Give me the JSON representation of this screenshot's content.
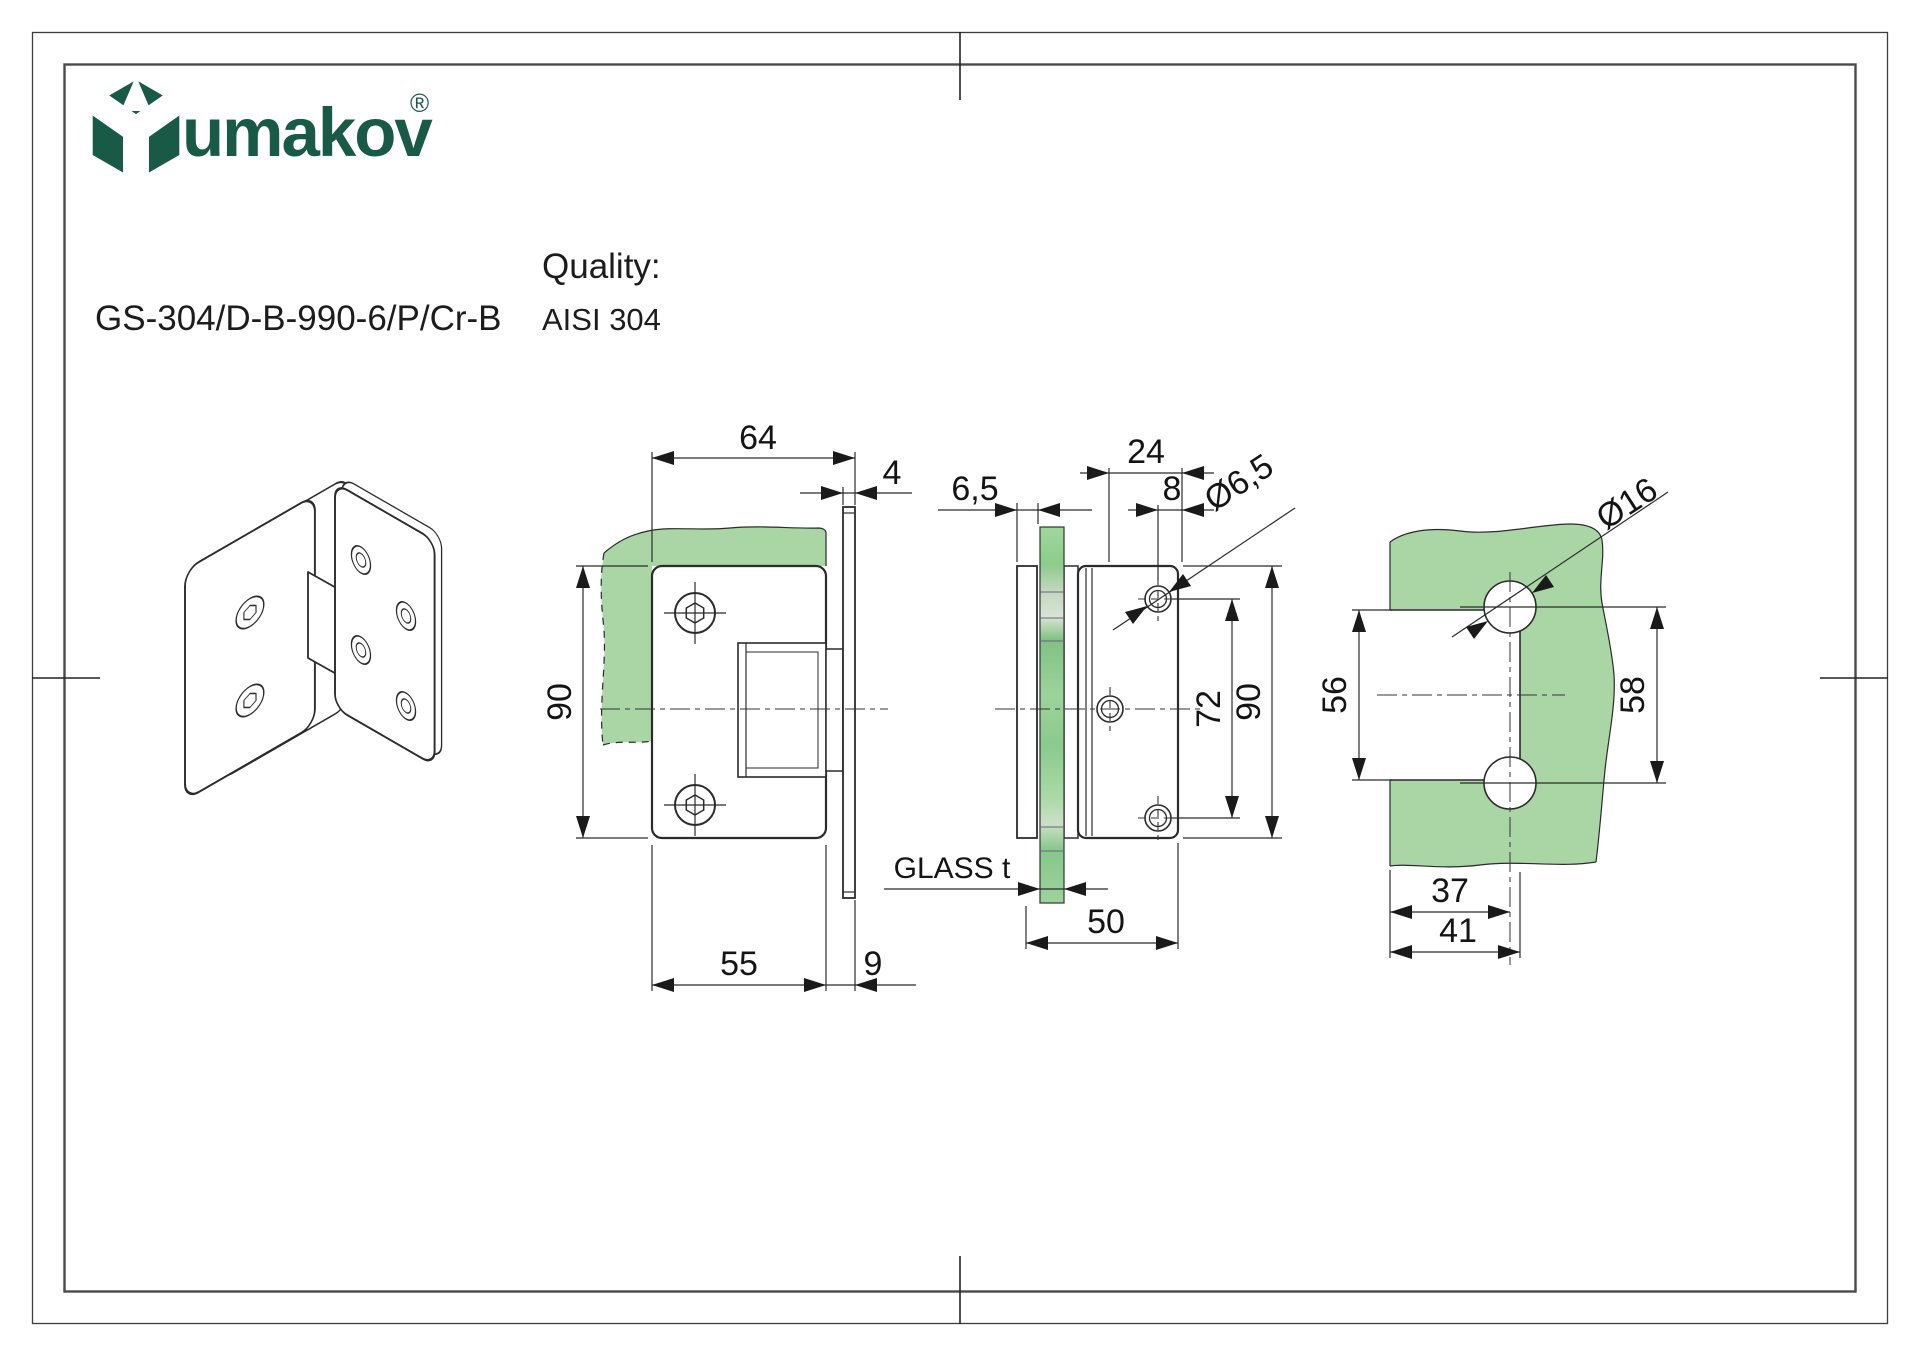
{
  "colors": {
    "brand-green": "#185a46",
    "glass-green": "#a9d6a4",
    "line-dark": "#2b2b2b"
  },
  "header": {
    "logo_text": "umakov",
    "registered_mark": "®",
    "product_code": "GS-304/D-B-990-6/P/Cr-B",
    "quality_label": "Quality:",
    "quality_value": "AISI 304"
  },
  "views": {
    "front": {
      "dims": {
        "width": "64",
        "wall_thickness": "4",
        "height": "90",
        "plate_width": "55",
        "offset": "9"
      }
    },
    "side": {
      "dims": {
        "cover_thickness": "6,5",
        "plate_depth": "24",
        "hole_offset": "8",
        "hole_dia": "Ø6,5",
        "hole_spacing": "72",
        "height": "90",
        "glass_label": "GLASS t",
        "depth": "50"
      }
    },
    "glass_prep": {
      "dims": {
        "cutout_height": "56",
        "hole_spacing": "58",
        "hole_dia": "Ø16",
        "hole_center_offset": "37",
        "cutout_depth": "41"
      }
    }
  }
}
